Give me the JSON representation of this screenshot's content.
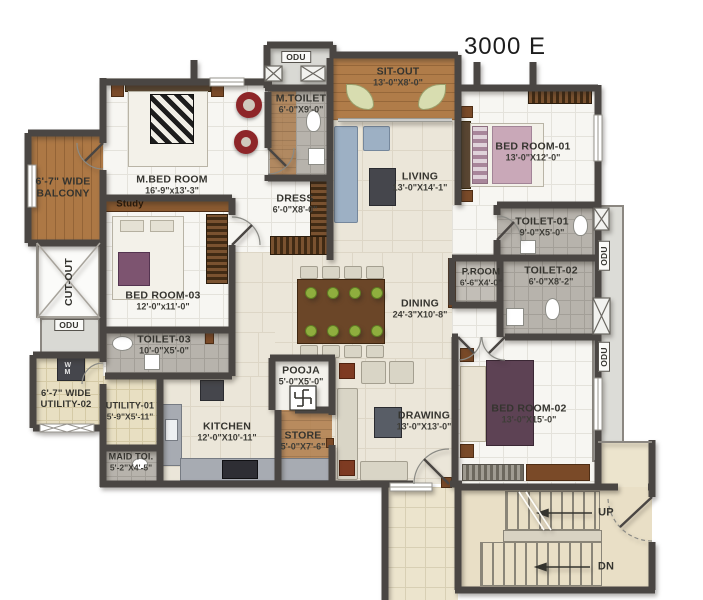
{
  "title": "3000 E",
  "rooms": {
    "mbed": {
      "name": "M.BED ROOM",
      "dims": "16'-9\"x13'-3\""
    },
    "bed01": {
      "name": "BED ROOM-01",
      "dims": "13'-0\"X12'-0\""
    },
    "bed02": {
      "name": "BED ROOM-02",
      "dims": "13'-0\"X15'-0\""
    },
    "bed03": {
      "name": "BED ROOM-03",
      "dims": "12'-0\"x11'-0\""
    },
    "living": {
      "name": "LIVING",
      "dims": "13'-0\"X14'-1\""
    },
    "dining": {
      "name": "DINING",
      "dims": "24'-3\"X10'-8\""
    },
    "drawing": {
      "name": "DRAWING",
      "dims": "13'-0\"X13'-0\""
    },
    "kitchen": {
      "name": "KITCHEN",
      "dims": "12'-0\"X10'-11\""
    },
    "sitout": {
      "name": "SIT-OUT",
      "dims": "13'-0\"X8'-0\""
    },
    "mtoilet": {
      "name": "M.TOILET",
      "dims": "6'-0\"X9'-0\""
    },
    "dress": {
      "name": "DRESS",
      "dims": "6'-0\"X8'-0\""
    },
    "toilet01": {
      "name": "TOILET-01",
      "dims": "9'-0\"X5'-0\""
    },
    "toilet02": {
      "name": "TOILET-02",
      "dims": "6'-0\"X8'-2\""
    },
    "toilet03": {
      "name": "TOILET-03",
      "dims": "10'-0\"X5'-0\""
    },
    "proom": {
      "name": "P.ROOM",
      "dims": "6'-6\"X4'-0\""
    },
    "pooja": {
      "name": "POOJA",
      "dims": "5'-0\"X5'-0\""
    },
    "store": {
      "name": "STORE",
      "dims": "5'-0\"X7'-6\""
    },
    "utility01": {
      "name": "UTILITY-01",
      "dims": "5'-9\"X5'-11\""
    },
    "utility02": {
      "name": "6'-7\" WIDE",
      "dims": "UTILITY-02"
    },
    "balcony": {
      "name": "6'-7\" WIDE",
      "dims": "BALCONY"
    },
    "maid": {
      "name": "MAID TOI.",
      "dims": "5'-2\"X4'-5\""
    },
    "cutout": {
      "name": "CUT-OUT"
    },
    "study": {
      "name": "Study"
    }
  },
  "labels": {
    "odu": "ODU",
    "up": "UP",
    "dn": "DN",
    "wm": "W M"
  },
  "colors": {
    "wall": "#4a4643",
    "wood": "#b07c49",
    "cream_floor": "#ebe6d9",
    "tile_floor": "#f7f6f2",
    "toilet_floor": "#b7b3ac",
    "utility_floor": "#e8dfc2",
    "stair_floor": "#e9dfc6",
    "accent_red": "#8e2629",
    "bed_purple": "#5d4254",
    "bed_pink": "#c9a8b8",
    "plate_green": "#8fae3e",
    "counter_gray": "#a7abb2",
    "jamb_brown": "#8a4a2c"
  }
}
